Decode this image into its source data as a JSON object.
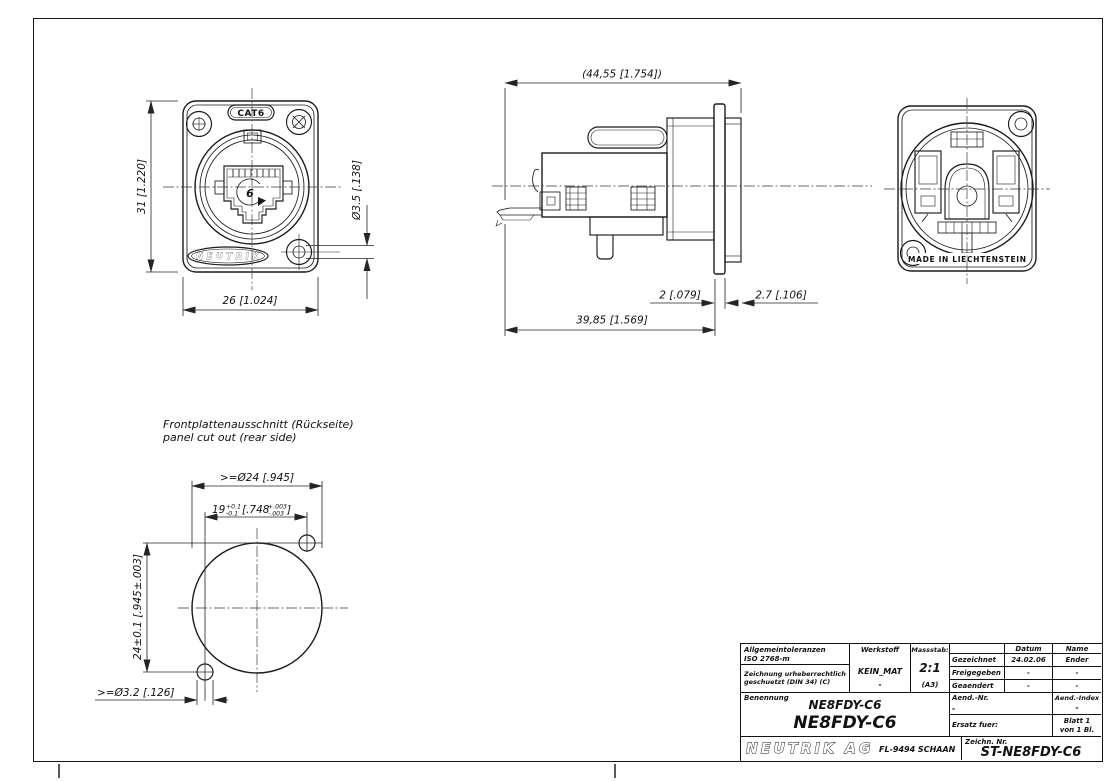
{
  "drawing": {
    "front": {
      "cat6_label": "CAT6",
      "brand_badge": "NEUTRIK",
      "center_digit": "6",
      "dim_height": "31 [1.220]",
      "dim_width": "26 [1.024]",
      "dim_hole": "Ø3.5 [.138]"
    },
    "side": {
      "dim_overall": "(44,55 [1.754])",
      "dim_depth": "39,85 [1.569]",
      "dim_flange": "2 [.079]",
      "dim_bushing": "2.7 [.106]"
    },
    "rear": {
      "made_in": "MADE IN LIECHTENSTEIN"
    },
    "cutout": {
      "title_de": "Frontplattenausschnitt (Rückseite)",
      "title_en": "panel cut out (rear side)",
      "dim_diameter": ">=Ø24 [.945]",
      "dim_spacing_value": "19",
      "dim_spacing_tol_plus": "+0.1",
      "dim_spacing_tol_minus": "-0.1",
      "dim_spacing_inch": "[.748",
      "dim_spacing_inch_tol_plus": "+.003",
      "dim_spacing_inch_tol_minus": "-.003",
      "dim_spacing_close": "]",
      "dim_vertical": "24±0.1 [.945±.003]",
      "dim_small_hole": ">=Ø3.2 [.126]"
    }
  },
  "title_block": {
    "tolerances_line1": "Allgemeintoleranzen",
    "tolerances_line2": "ISO 2768-m",
    "copyright_line1": "Zeichnung urheberrechtlich",
    "copyright_line2": "geschuetzt (DIN 34) (C)",
    "werkstoff_label": "Werkstoff",
    "werkstoff_value": "KEIN_MAT",
    "werkstoff_value2": "-",
    "massstab_label": "Massstab:",
    "massstab_value": "2:1",
    "massstab_format": "(A3)",
    "col_datum": "Datum",
    "col_name": "Name",
    "rows": [
      {
        "label": "Gezeichnet",
        "datum": "24.02.06",
        "name": "Ender"
      },
      {
        "label": "Freigegeben",
        "datum": "-",
        "name": "-"
      },
      {
        "label": "Geaendert",
        "datum": "-",
        "name": "-"
      }
    ],
    "benennung_label": "Benennung",
    "benennung_value1": "NE8FDY-C6",
    "benennung_value2": "NE8FDY-C6",
    "aend_nr_label": "Aend.-Nr.",
    "aend_nr_value": "-",
    "aend_index_label": "Aend.-Index",
    "aend_index_value": "-",
    "ersatz_label": "Ersatz fuer:",
    "blatt_line1": "Blatt 1",
    "blatt_line2": "von 1 Bl.",
    "company_logo": "NEUTRIK AG",
    "company_address": "FL-9494 SCHAAN",
    "zeichn_label": "Zeichn. Nr.",
    "zeichn_value": "ST-NE8FDY-C6"
  }
}
